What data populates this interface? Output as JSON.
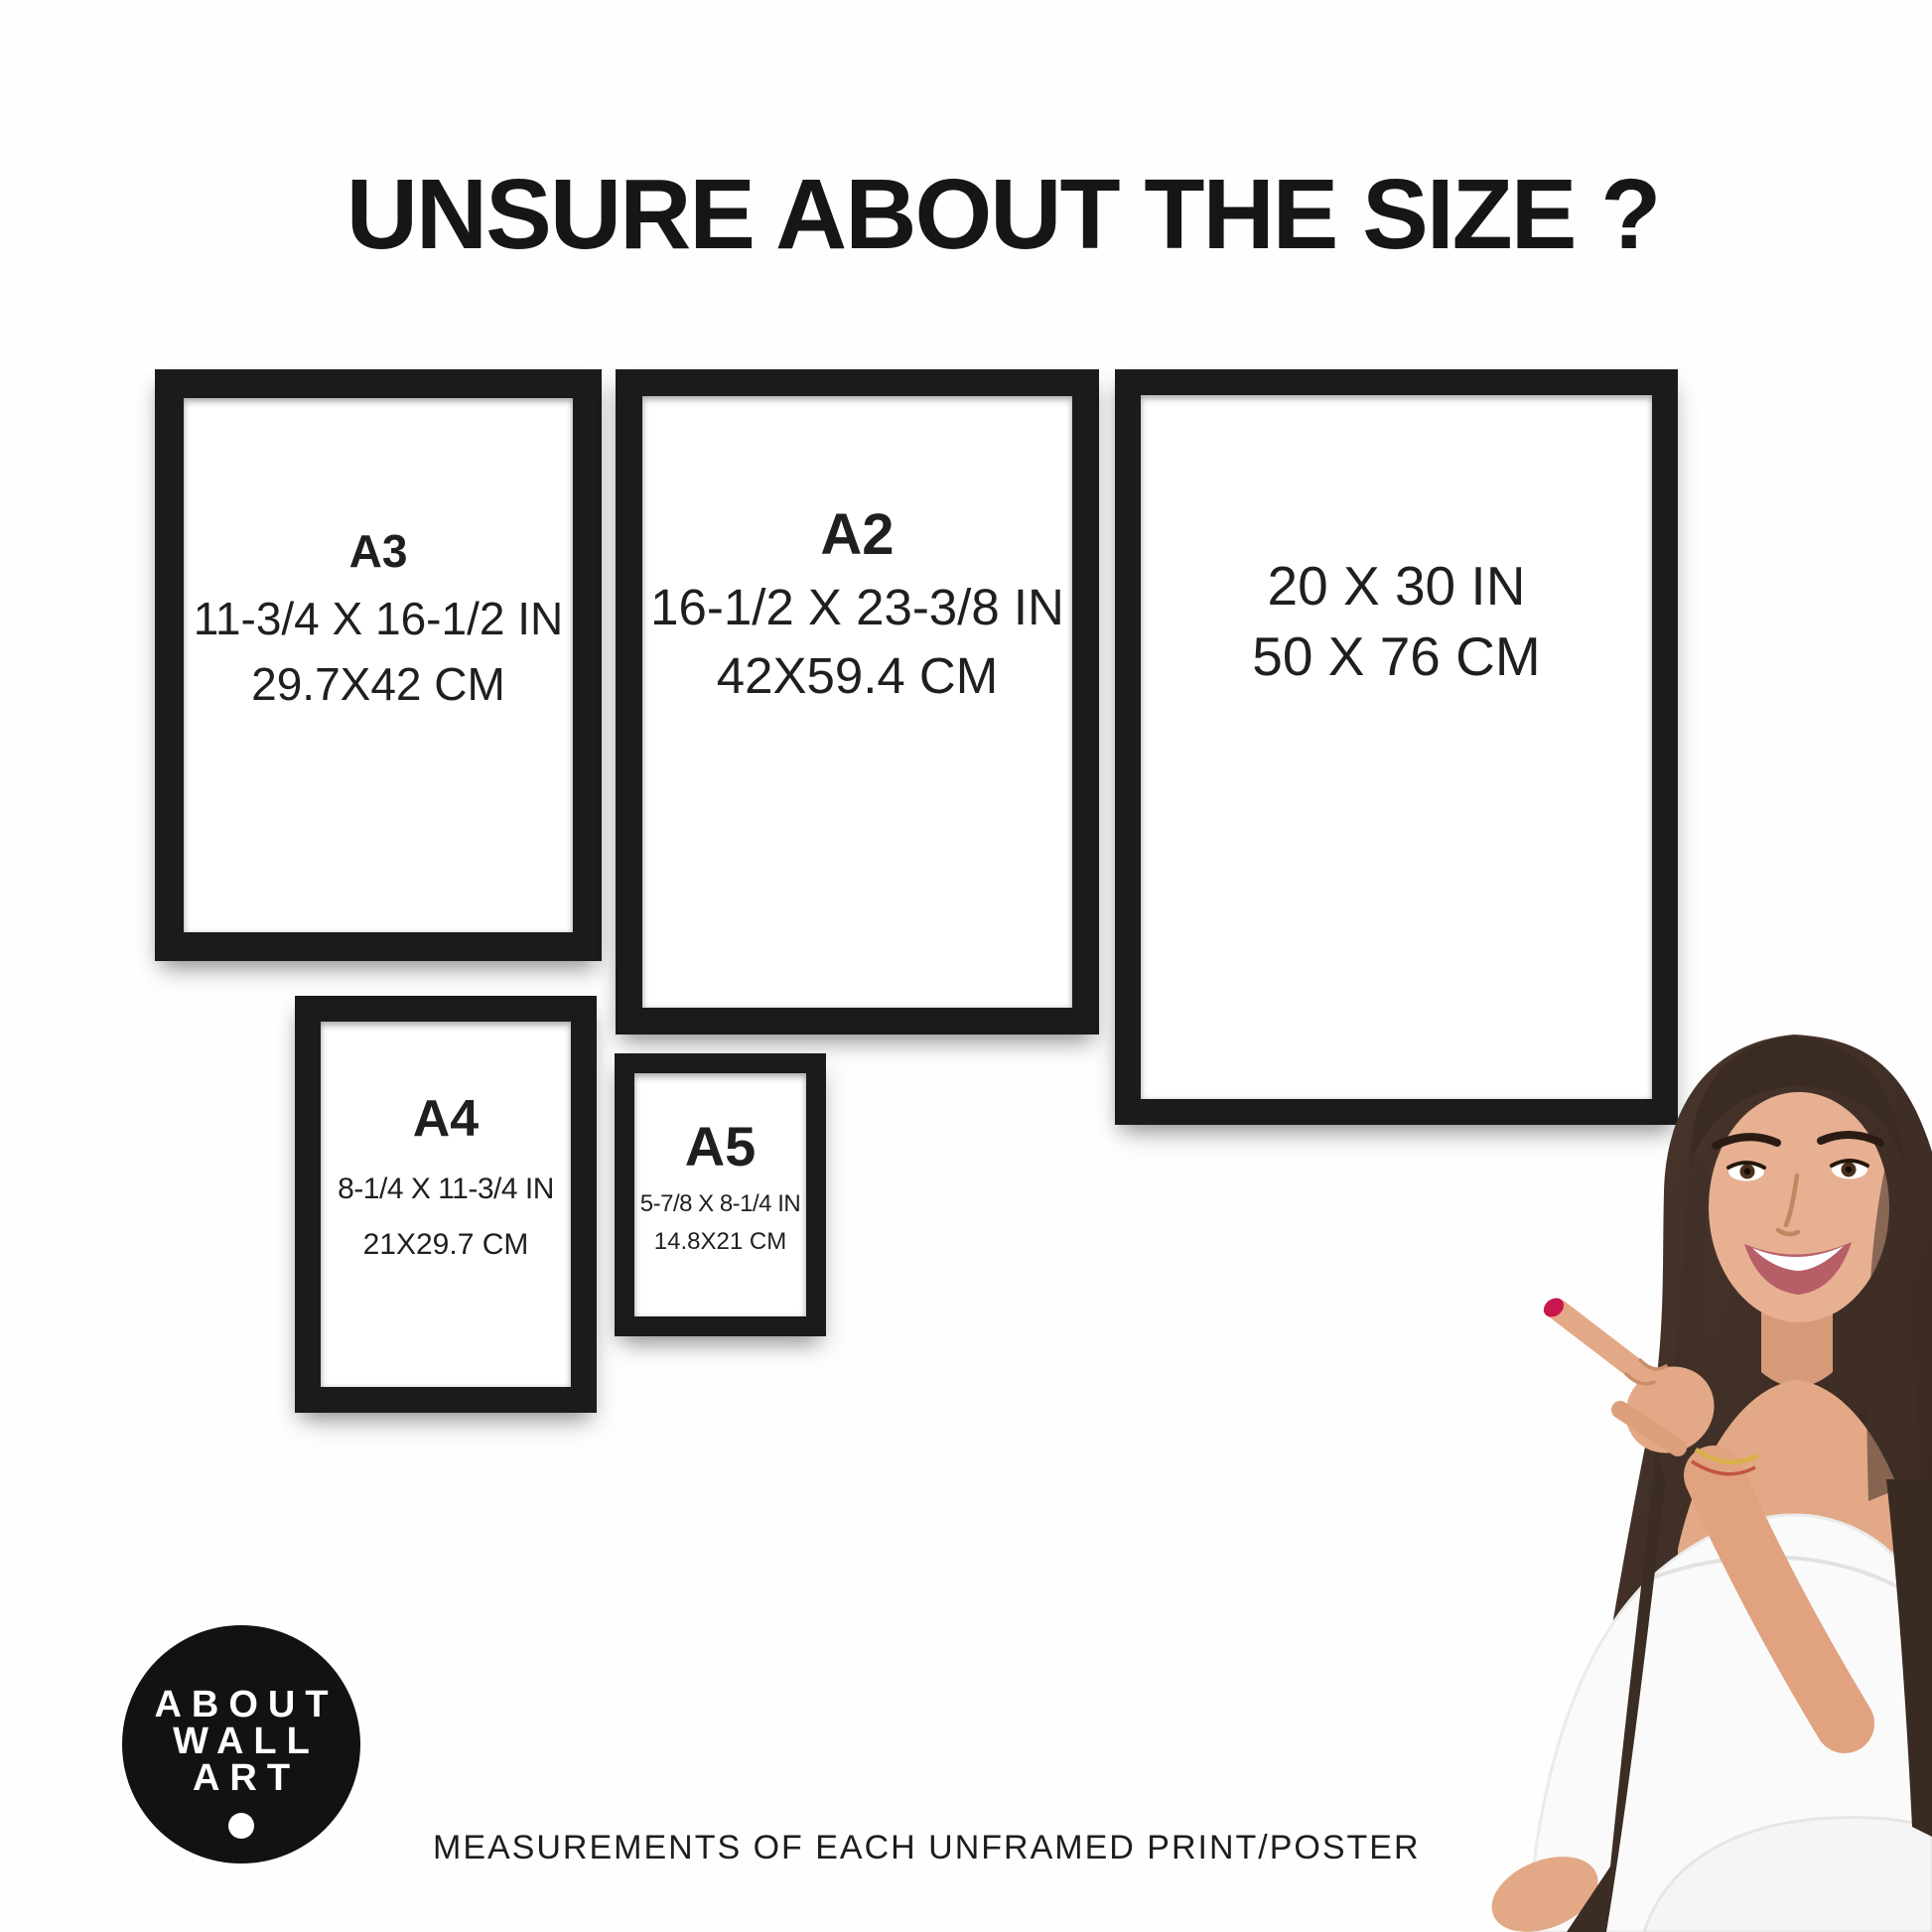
{
  "title": "UNSURE ABOUT THE SIZE ?",
  "frames": [
    {
      "label": "A3",
      "inches": "11-3/4 X 16-1/2 IN",
      "cm": "29.7X42 CM"
    },
    {
      "label": "A2",
      "inches": "16-1/2 X 23-3/8 IN",
      "cm": "42X59.4 CM"
    },
    {
      "label": "",
      "inches": "20 X 30 IN",
      "cm": "50 X 76 CM"
    },
    {
      "label": "A4",
      "inches": "8-1/4 X 11-3/4 IN",
      "cm": "21X29.7 CM"
    },
    {
      "label": "A5",
      "inches": "5-7/8 X 8-1/4 IN",
      "cm": "14.8X21 CM"
    }
  ],
  "logo": {
    "lines": [
      "ABOUT",
      "WALL",
      "ART"
    ]
  },
  "footer": {
    "caption": "MEASUREMENTS OF EACH UNFRAMED PRINT/POSTER"
  },
  "colors": {
    "frame_black": "#1a1b1d",
    "text_black": "#1c1c1c",
    "logo_black": "#121212",
    "background": "#fefefe",
    "nail_red": "#c8184d"
  },
  "figure": {
    "name": "woman-pointing-photo"
  }
}
